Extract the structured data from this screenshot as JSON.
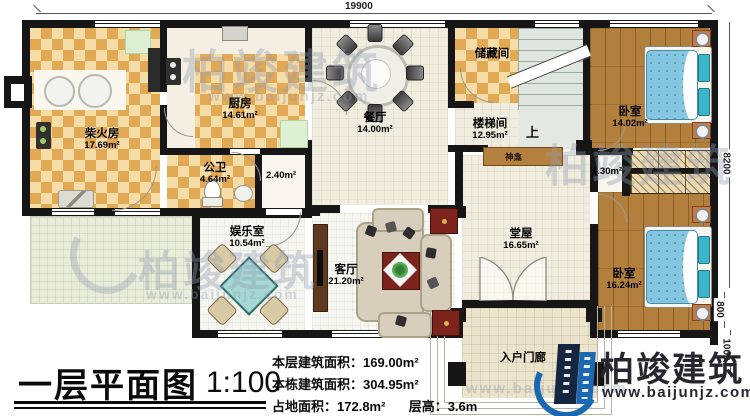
{
  "title": {
    "main": "一层平面图",
    "scale": "1:100"
  },
  "dimensions": {
    "top": "19900",
    "right": "8200",
    "sub800": "800",
    "sub1000": "1000"
  },
  "stats": {
    "floor_area_label": "本层建筑面积：",
    "floor_area_value": "169.00m²",
    "building_area_label": "本栋建筑面积：",
    "building_area_value": "304.95m²",
    "footprint_label": "占地面积：",
    "footprint_value": "172.8m²",
    "height_label": "层高：",
    "height_value": "3.6m"
  },
  "rooms": {
    "firewood": {
      "name": "柴火房",
      "area": "17.69m²"
    },
    "kitchen": {
      "name": "厨房",
      "area": "14.61m²"
    },
    "bathroom": {
      "name": "公卫",
      "area": "4.64m²"
    },
    "hallway": {
      "area": "2.40m²"
    },
    "dining": {
      "name": "餐厅",
      "area": "14.00m²"
    },
    "storage": {
      "name": "储藏间"
    },
    "stairwell": {
      "name": "楼梯间",
      "area": "12.95m²",
      "up_label": "上"
    },
    "shrine": {
      "name": "神龛"
    },
    "passage": {
      "area": "1.30m²"
    },
    "bedroom_top": {
      "name": "卧室",
      "area": "14.02m²"
    },
    "hall": {
      "name": "堂屋",
      "area": "16.65m²"
    },
    "bedroom_bottom": {
      "name": "卧室",
      "area": "16.24m²"
    },
    "living": {
      "name": "客厅",
      "area": "21.20m²"
    },
    "recreation": {
      "name": "娱乐室",
      "area": "10.54m²"
    },
    "porch": {
      "name": "入户门廊"
    }
  },
  "logo": {
    "name": "柏竣建筑",
    "url": "www.baijunjz.com"
  },
  "watermark": {
    "name": "柏竣建筑",
    "url": "www.baijunjz.com"
  }
}
